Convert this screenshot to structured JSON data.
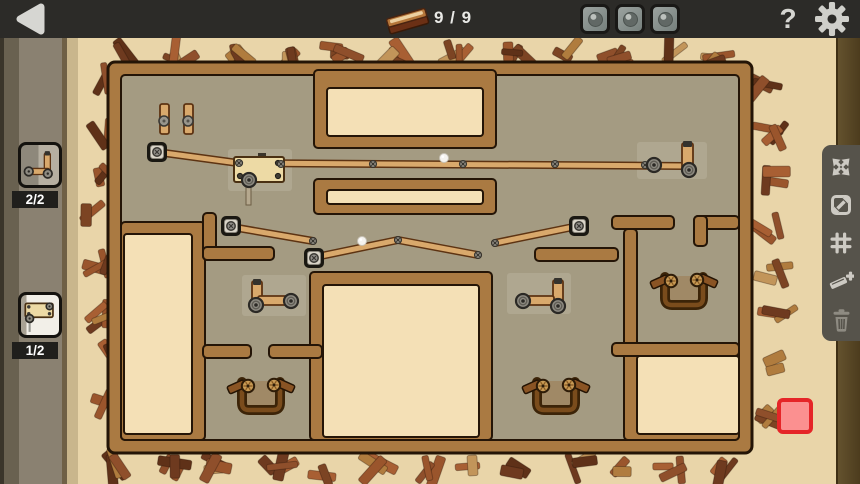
{
  "topbar": {
    "plank_count": "9 / 9",
    "help_glyph": "?"
  },
  "inventory": {
    "items": [
      {
        "name": "pulley-bracket",
        "count": "2/2"
      },
      {
        "name": "winch",
        "count": "1/2"
      }
    ]
  },
  "side_toolbar": {
    "icons": [
      "expand-view",
      "resize",
      "grid-snap",
      "add-plank",
      "delete"
    ]
  },
  "colors": {
    "topbar_bg": "#2c2b28",
    "scene_bg": "#e9d5a9",
    "floor": "#a49b82",
    "wall": "#aa7a42",
    "wall_outline": "#241507",
    "room": "#f4e0b6",
    "plank": "#d9a96c",
    "plank_outline": "#5d3312",
    "metal": "#8e8b82",
    "metal_dark": "#2b2925",
    "wood_dark": "#3c2408",
    "accent_red": "#e52528",
    "red_fill": "#fb9090",
    "toolbar_bg": "#56534b",
    "icon": "#cdcac3",
    "icon_dim": "#8e8b82"
  },
  "board": {
    "outer": [
      108,
      62,
      644,
      391
    ],
    "floor": [
      121,
      75,
      618,
      365
    ],
    "walls": [
      [
        314,
        70,
        182,
        78
      ],
      [
        314,
        179,
        182,
        35
      ],
      [
        121,
        222,
        84,
        218
      ],
      [
        310,
        272,
        182,
        168
      ],
      [
        624,
        343,
        115,
        97
      ],
      [
        203,
        213,
        13,
        47
      ],
      [
        203,
        247,
        71,
        13
      ],
      [
        203,
        345,
        48,
        13
      ],
      [
        269,
        345,
        53,
        13
      ],
      [
        535,
        248,
        83,
        13
      ],
      [
        612,
        216,
        62,
        13
      ],
      [
        694,
        216,
        45,
        13
      ],
      [
        694,
        216,
        13,
        30
      ],
      [
        624,
        229,
        13,
        126
      ],
      [
        612,
        343,
        127,
        13
      ]
    ],
    "rooms": [
      [
        327,
        88,
        156,
        48
      ],
      [
        327,
        190,
        156,
        14
      ],
      [
        124,
        234,
        68,
        200
      ],
      [
        323,
        285,
        156,
        152
      ],
      [
        637,
        356,
        102,
        78
      ]
    ],
    "highlights": [
      [
        228,
        149,
        64,
        42
      ],
      [
        637,
        142,
        70,
        37
      ],
      [
        242,
        275,
        64,
        41
      ],
      [
        507,
        273,
        64,
        41
      ]
    ],
    "planks": [
      [
        157,
        152,
        238,
        163
      ],
      [
        238,
        163,
        686,
        166
      ],
      [
        232,
        227,
        313,
        241
      ],
      [
        316,
        257,
        398,
        240
      ],
      [
        398,
        240,
        478,
        255
      ],
      [
        495,
        243,
        578,
        226
      ]
    ],
    "vplanks": [
      {
        "r": [
          160,
          104,
          9,
          30
        ]
      },
      {
        "r": [
          184,
          104,
          9,
          30
        ]
      },
      {
        "r": [
          682,
          143,
          11,
          29
        ],
        "cap": "both"
      },
      {
        "r": [
          252,
          281,
          10,
          29
        ],
        "cap": "top"
      },
      {
        "r": [
          553,
          280,
          10,
          30
        ],
        "cap": "top"
      }
    ],
    "hplanks": [
      [
        258,
        296,
        34,
        9
      ],
      [
        518,
        296,
        36,
        9
      ]
    ],
    "rope": [
      246,
      183,
      5,
      22
    ],
    "winch": {
      "body": [
        234,
        157,
        50,
        25
      ],
      "bolts": [
        [
          240,
          163
        ],
        [
          278,
          163
        ],
        [
          240,
          176
        ],
        [
          278,
          176
        ]
      ]
    },
    "anchors": [
      [
        157,
        152
      ],
      [
        231,
        226
      ],
      [
        314,
        258
      ],
      [
        579,
        226
      ]
    ],
    "bolts": [
      [
        239,
        163
      ],
      [
        281,
        164
      ],
      [
        373,
        164
      ],
      [
        463,
        164
      ],
      [
        555,
        164
      ],
      [
        645,
        165
      ],
      [
        313,
        241
      ],
      [
        398,
        240
      ],
      [
        478,
        255
      ],
      [
        495,
        243
      ]
    ],
    "pulleys": [
      [
        249,
        180
      ],
      [
        654,
        165
      ],
      [
        689,
        170
      ],
      [
        256,
        305
      ],
      [
        291,
        301
      ],
      [
        523,
        301
      ],
      [
        558,
        306
      ]
    ],
    "pegs": [
      [
        164,
        121
      ],
      [
        188,
        121
      ]
    ],
    "balls": [
      [
        444,
        158
      ],
      [
        362,
        241
      ]
    ],
    "catchers": [
      [
        261,
        396
      ],
      [
        684,
        291
      ],
      [
        556,
        396
      ]
    ]
  }
}
